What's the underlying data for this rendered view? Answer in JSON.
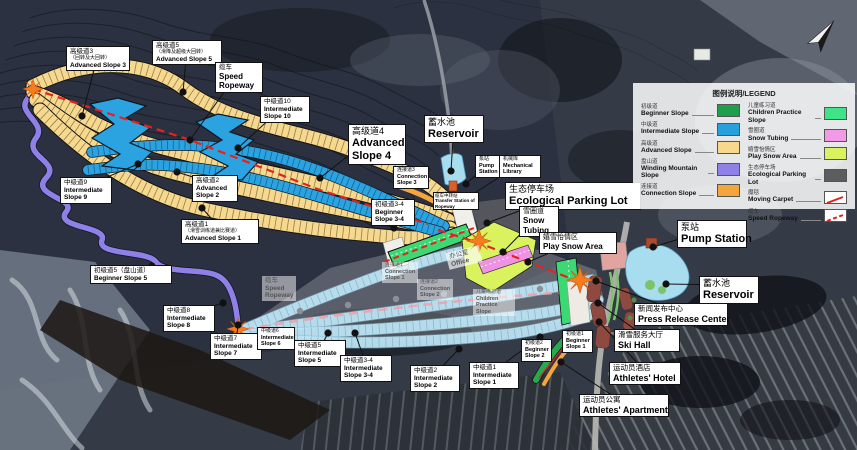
{
  "legend": {
    "title": "图例说明/LEGEND",
    "left": [
      {
        "zh": "初级道",
        "en": "Beginner Slope",
        "color": "#1f9e4b"
      },
      {
        "zh": "中级道",
        "en": "Intermediate Slope",
        "color": "#27a0dc"
      },
      {
        "zh": "高级道",
        "en": "Advanced Slope",
        "color": "#f6d88e"
      },
      {
        "zh": "盘山道",
        "en": "Winding Mountain Slope",
        "color": "#8f80e8"
      },
      {
        "zh": "连接道",
        "en": "Connection Slope",
        "color": "#f5a53d"
      }
    ],
    "right": [
      {
        "zh": "儿童练习道",
        "en": "Children Practice Slope",
        "color": "#3fe388"
      },
      {
        "zh": "雪圈道",
        "en": "Snow Tubing",
        "color": "#f19ae8"
      },
      {
        "zh": "嬉雪怡情区",
        "en": "Play Snow Area",
        "color": "#d9f25e"
      },
      {
        "zh": "生态停车场",
        "en": "Ecological Parking Lot",
        "color": "#5d5d5d"
      },
      {
        "zh": "魔毯",
        "en": "Moving Carpet",
        "line": "solid",
        "color": "#e0201c"
      },
      {
        "zh": "缆车",
        "en": "Speed Ropeway",
        "line": "dashed",
        "color": "#e0201c"
      }
    ]
  },
  "labels": [
    {
      "id": "adv3",
      "zh": "高级道3",
      "zh2": "（回转及大回转）",
      "en": "Advanced Slope 3"
    },
    {
      "id": "adv5",
      "zh": "高级道5",
      "zh2": "（滑降及超级大回转）",
      "en": "Advanced Slope 5"
    },
    {
      "id": "rope1",
      "zh": "缆车",
      "en": "Speed Ropeway"
    },
    {
      "id": "int10",
      "zh": "中级道10",
      "en": "Intermediate Slope 10"
    },
    {
      "id": "adv4",
      "zh": "高级道4",
      "en": "Advanced Slope 4"
    },
    {
      "id": "res1",
      "zh": "蓄水池",
      "en": "Reservoir"
    },
    {
      "id": "conn3",
      "zh": "连接道3",
      "en": "Connection Slope 3"
    },
    {
      "id": "pump1",
      "zh": "泵站",
      "en": "Pump Station"
    },
    {
      "id": "mech",
      "zh": "机械库",
      "en": "Mechanical Library"
    },
    {
      "id": "park",
      "zh": "生态停车场",
      "en": "Ecological Parking Lot"
    },
    {
      "id": "tube",
      "zh": "雪圈道",
      "en": "Snow Tubing"
    },
    {
      "id": "play",
      "zh": "嬉雪怡情区",
      "en": "Play Snow Area"
    },
    {
      "id": "transfer",
      "zh": "缆车中转站",
      "en": "Transfer Station of Ropeway"
    },
    {
      "id": "beg34",
      "zh": "初级道3-4",
      "en": "Beginner Slope 3-4"
    },
    {
      "id": "int9",
      "zh": "中级道9",
      "en": "Intermediate Slope 9"
    },
    {
      "id": "adv2",
      "zh": "高级道2",
      "en": "Advanced Slope 2"
    },
    {
      "id": "adv1",
      "zh": "高级道1",
      "zh2": "（滑雪训练道兼比赛道）",
      "en": "Advanced Slope 1"
    },
    {
      "id": "beg5",
      "zh": "初级道5（盘山道）",
      "en": "Beginner Slope 5"
    },
    {
      "id": "int8",
      "zh": "中级道8",
      "en": "Intermediate Slope 8"
    },
    {
      "id": "int7",
      "zh": "中级道7",
      "en": "Intermediate Slope 7"
    },
    {
      "id": "int6",
      "zh": "中级道6",
      "en": "Intermediate Slope 6"
    },
    {
      "id": "rope2",
      "zh": "缆车",
      "en": "Speed Ropeway"
    },
    {
      "id": "int5",
      "zh": "中级道5",
      "en": "Intermediate Slope 5"
    },
    {
      "id": "int34",
      "zh": "中级道3-4",
      "en": "Intermediate Slope 3-4"
    },
    {
      "id": "int2",
      "zh": "中级道2",
      "en": "Intermediate Slope 2"
    },
    {
      "id": "int1",
      "zh": "中级道1",
      "en": "Intermediate Slope 1"
    },
    {
      "id": "beg2",
      "zh": "初级道2",
      "en": "Beginner Slope 2"
    },
    {
      "id": "beg1",
      "zh": "初级道1",
      "en": "Beginner Slope 1"
    },
    {
      "id": "conn1",
      "zh": "连接道1",
      "en": "Connection Slope 1"
    },
    {
      "id": "conn2",
      "zh": "连接道2",
      "en": "Connection Slope 2"
    },
    {
      "id": "children",
      "zh": "儿童练习道",
      "en": "Children Practice Slope"
    },
    {
      "id": "office",
      "zh": "办公室",
      "en": "Office"
    },
    {
      "id": "pump2",
      "zh": "泵站",
      "en": "Pump Station"
    },
    {
      "id": "res2",
      "zh": "蓄水池",
      "en": "Reservoir"
    },
    {
      "id": "press",
      "zh": "新闻发布中心",
      "en": "Press Release Center"
    },
    {
      "id": "skihall",
      "zh": "滑雪服务大厅",
      "en": "Ski Hall"
    },
    {
      "id": "hotel",
      "zh": "运动员酒店",
      "en": "Athletes' Hotel"
    },
    {
      "id": "apt",
      "zh": "运动员公寓",
      "en": "Athletes' Apartment"
    }
  ]
}
